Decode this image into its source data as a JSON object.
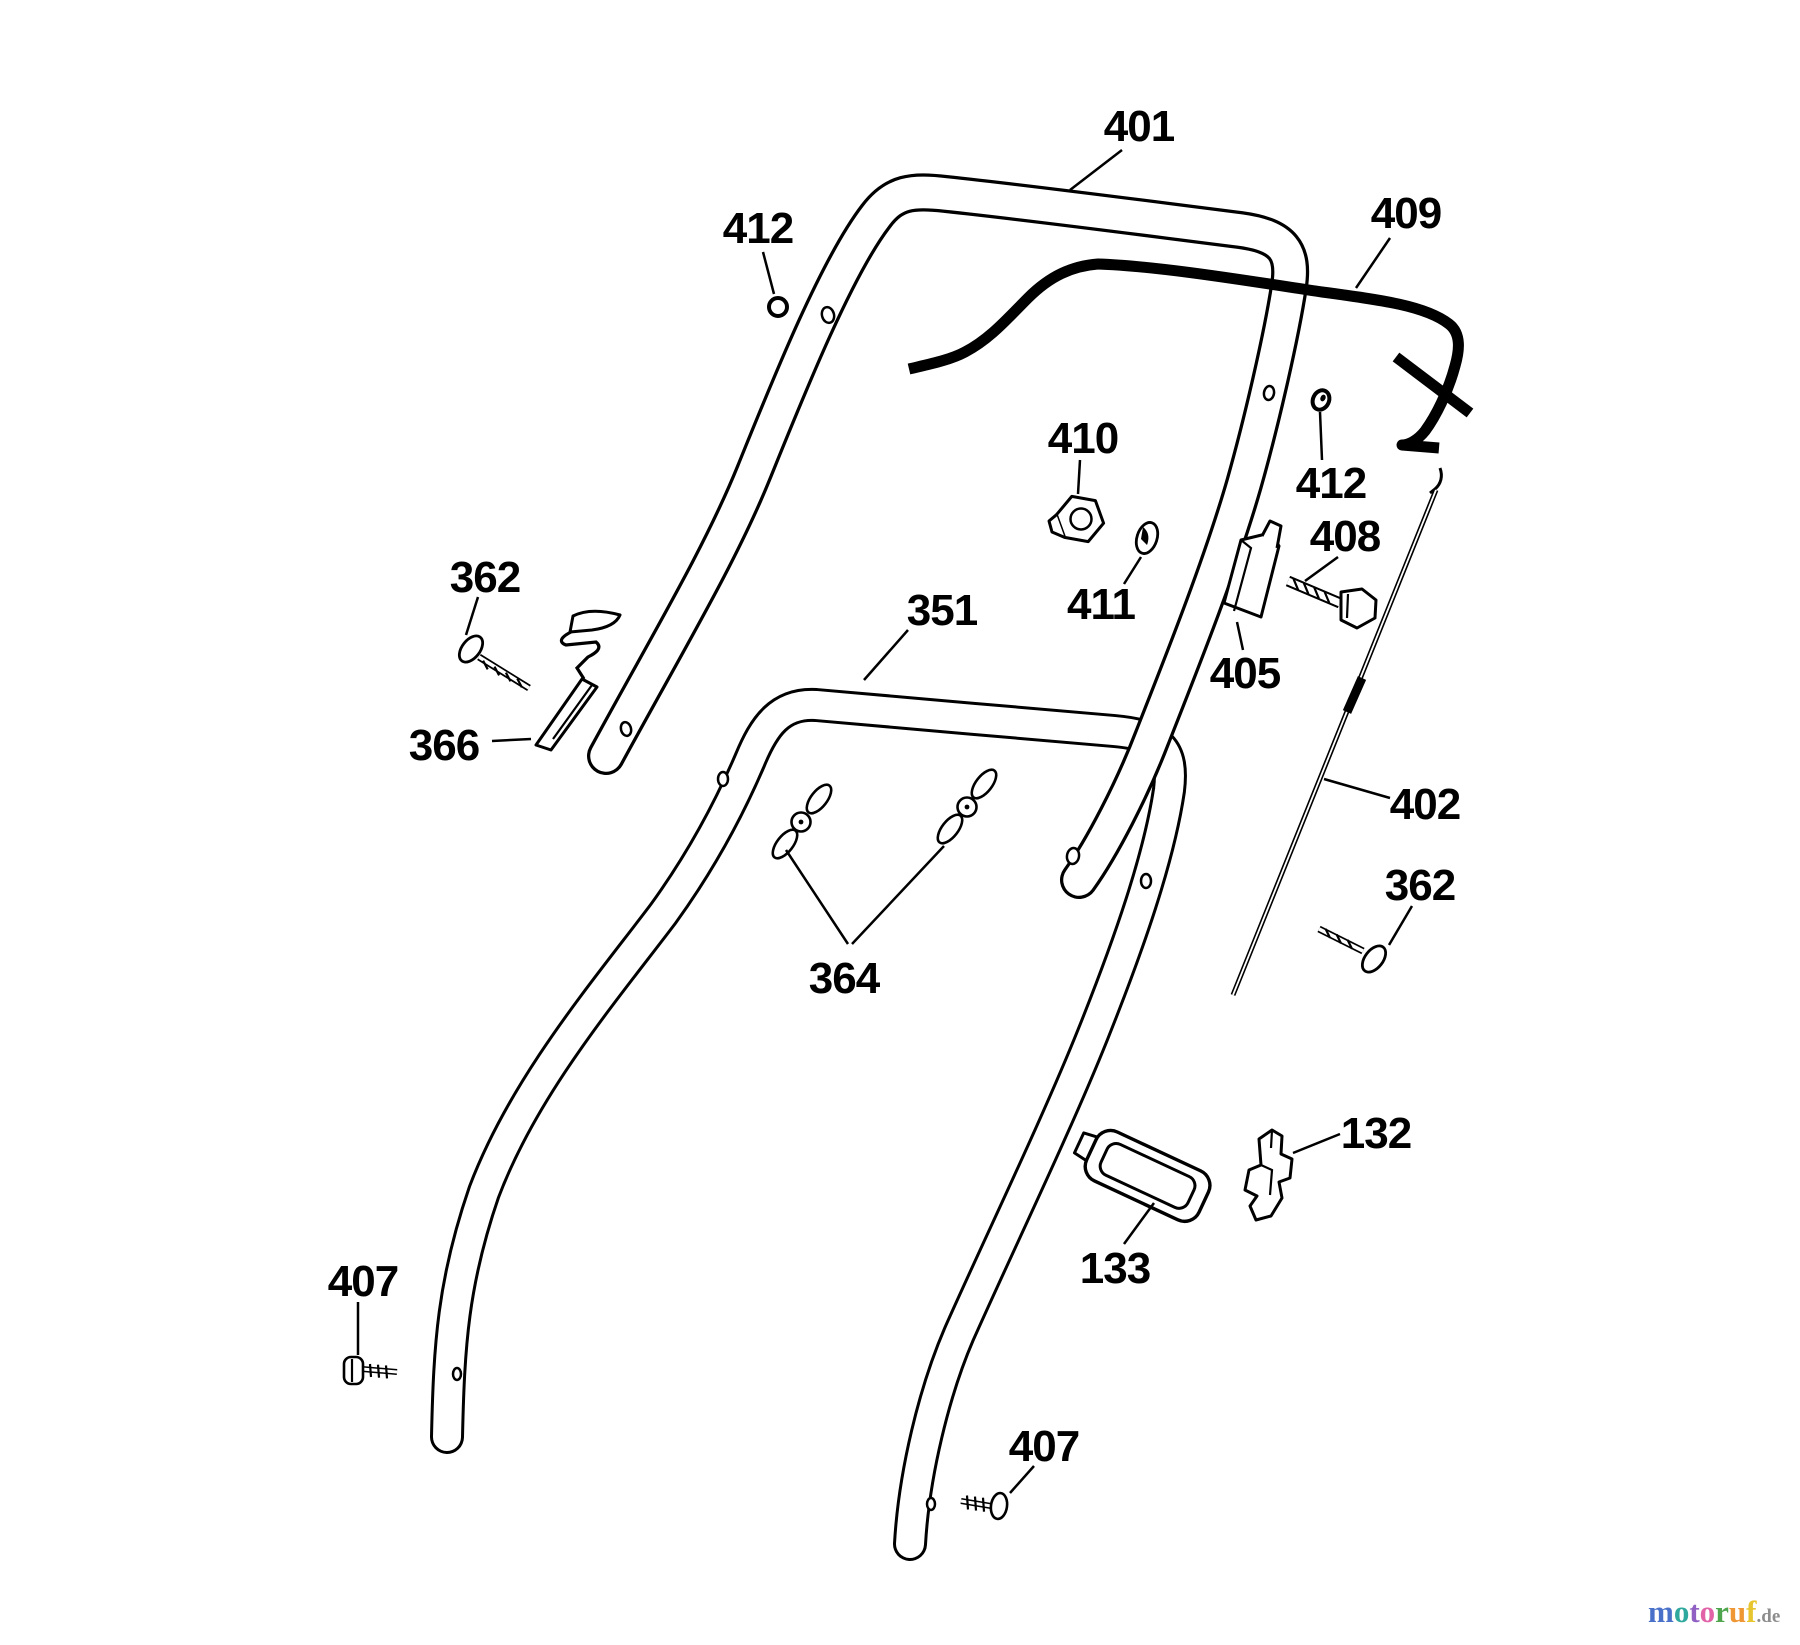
{
  "diagram": {
    "type": "exploded-parts-diagram",
    "subject": "mower handle assembly parts drawing",
    "background_color": "#ffffff",
    "line_color": "#000000",
    "labels": [
      {
        "id": "401",
        "text": "401"
      },
      {
        "id": "409",
        "text": "409"
      },
      {
        "id": "412-left",
        "text": "412"
      },
      {
        "id": "410",
        "text": "410"
      },
      {
        "id": "411",
        "text": "411"
      },
      {
        "id": "412-right",
        "text": "412"
      },
      {
        "id": "408",
        "text": "408"
      },
      {
        "id": "405",
        "text": "405"
      },
      {
        "id": "351",
        "text": "351"
      },
      {
        "id": "402",
        "text": "402"
      },
      {
        "id": "362-left",
        "text": "362"
      },
      {
        "id": "366",
        "text": "366"
      },
      {
        "id": "362-right",
        "text": "362"
      },
      {
        "id": "364",
        "text": "364"
      },
      {
        "id": "407-left",
        "text": "407"
      },
      {
        "id": "407-right",
        "text": "407"
      },
      {
        "id": "133",
        "text": "133"
      },
      {
        "id": "132",
        "text": "132"
      }
    ],
    "parts": [
      {
        "number": "401",
        "shape": "upper handle bar tube"
      },
      {
        "number": "351",
        "shape": "lower handle bar tube"
      },
      {
        "number": "409",
        "shape": "control cable (bold line)"
      },
      {
        "number": "402",
        "shape": "long thin rod"
      },
      {
        "number": "410",
        "shape": "hex nut"
      },
      {
        "number": "411",
        "shape": "cup washer"
      },
      {
        "number": "412",
        "shape": "small cap nut (two places)"
      },
      {
        "number": "408",
        "shape": "hex head bolt"
      },
      {
        "number": "405",
        "shape": "sheet clip"
      },
      {
        "number": "362",
        "shape": "flat head screw (two places)"
      },
      {
        "number": "366",
        "shape": "wire cable guide clip"
      },
      {
        "number": "364",
        "shape": "wing nut (two pieces)"
      },
      {
        "number": "407",
        "shape": "pan head screw (two places)"
      },
      {
        "number": "133",
        "shape": "rounded frame gasket"
      },
      {
        "number": "132",
        "shape": "latch clip"
      }
    ]
  },
  "watermark": {
    "text": "motoruf",
    "suffix": ".de",
    "suffix_color": "#8d8d8d",
    "letters": [
      {
        "ch": "m",
        "color": "#4a71c9"
      },
      {
        "ch": "o",
        "color": "#2fa89e"
      },
      {
        "ch": "t",
        "color": "#9061c2"
      },
      {
        "ch": "o",
        "color": "#e262a8"
      },
      {
        "ch": "r",
        "color": "#4ea54e"
      },
      {
        "ch": "u",
        "color": "#ef9735"
      },
      {
        "ch": "f",
        "color": "#e7c52e"
      }
    ]
  }
}
